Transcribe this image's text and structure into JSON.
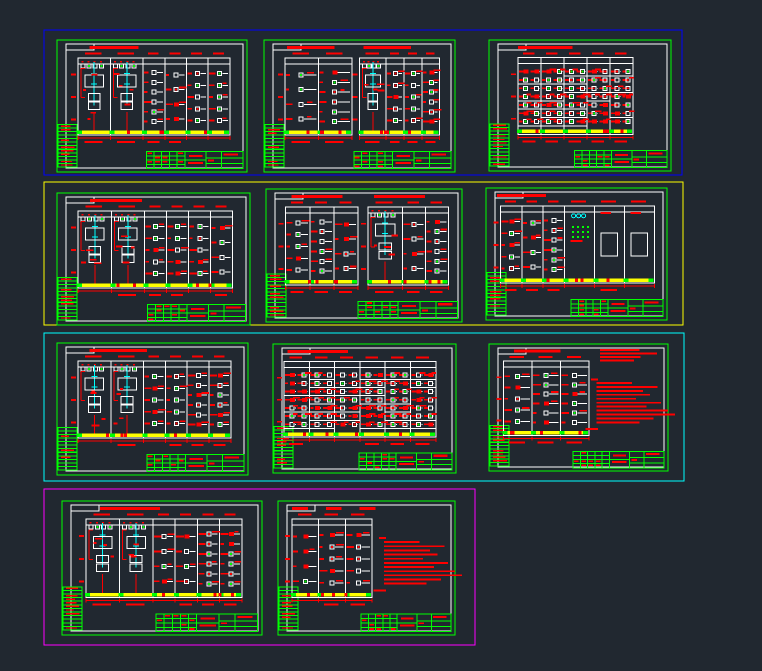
{
  "app": {
    "name": "cad-model-space",
    "background": "#212830",
    "width": 762,
    "height": 671
  },
  "palette": {
    "bg": "#212830",
    "red": "#ff0000",
    "green": "#00e000",
    "bright_green": "#00ff00",
    "white": "#ffffff",
    "yellow": "#ffff00",
    "cyan": "#00ffff",
    "blue": "#0000ff",
    "magenta": "#ff00ff"
  },
  "groups": [
    {
      "name": "group-blue",
      "border_color": "#0000ff",
      "rect": [
        44,
        30,
        638,
        145
      ],
      "sheets": [
        {
          "name": "sheet-r1s1",
          "seed": 11,
          "rect": [
            57,
            40,
            190,
            132
          ],
          "titles": [
            {
              "x": 0.17,
              "w": 0.26
            }
          ],
          "panels": [
            {
              "x0": 0.11,
              "x1": 0.91,
              "cols": 6,
              "feeders": 2
            }
          ]
        },
        {
          "name": "sheet-r1s2",
          "seed": 23,
          "rect": [
            264,
            40,
            191,
            132
          ],
          "titles": [
            {
              "x": 0.12,
              "w": 0.25
            },
            {
              "x": 0.52,
              "w": 0.25
            }
          ],
          "panels": [
            {
              "x0": 0.11,
              "x1": 0.46,
              "cols": 2,
              "feeders": 0
            },
            {
              "x0": 0.5,
              "x1": 0.92,
              "cols": 4,
              "feeders": 1
            }
          ]
        },
        {
          "name": "sheet-r1s3",
          "seed": 37,
          "rect": [
            489,
            40,
            182,
            131
          ],
          "titles": [
            {
              "x": 0.16,
              "w": 0.3
            }
          ],
          "panels": [
            {
              "x0": 0.16,
              "x1": 0.79,
              "cols": 5,
              "feeders": 0,
              "dense": true
            }
          ]
        }
      ]
    },
    {
      "name": "group-yellow",
      "border_color": "#ffff00",
      "rect": [
        44,
        182,
        639,
        143
      ],
      "sheets": [
        {
          "name": "sheet-r2s1",
          "seed": 41,
          "rect": [
            57,
            193,
            193,
            132
          ],
          "titles": [
            {
              "x": 0.17,
              "w": 0.27
            }
          ],
          "panels": [
            {
              "x0": 0.11,
              "x1": 0.91,
              "cols": 6,
              "feeders": 2
            }
          ]
        },
        {
          "name": "sheet-r2s2",
          "seed": 53,
          "rect": [
            266,
            189,
            196,
            133
          ],
          "titles": [
            {
              "x": 0.13,
              "w": 0.26
            },
            {
              "x": 0.55,
              "w": 0.26
            }
          ],
          "panels": [
            {
              "x0": 0.1,
              "x1": 0.47,
              "cols": 3,
              "feeders": 0
            },
            {
              "x0": 0.52,
              "x1": 0.93,
              "cols": 3,
              "feeders": 1
            }
          ]
        },
        {
          "name": "sheet-r2s3",
          "seed": 67,
          "rect": [
            486,
            188,
            181,
            132
          ],
          "titles": [
            {
              "x": 0.06,
              "w": 0.27
            }
          ],
          "panels": [
            {
              "x0": 0.08,
              "x1": 0.93,
              "cols": 6,
              "feeders": 0,
              "sparse_right": 3
            }
          ]
        }
      ]
    },
    {
      "name": "group-cyan",
      "border_color": "#00ffff",
      "rect": [
        44,
        333,
        640,
        148
      ],
      "sheets": [
        {
          "name": "sheet-r3s1",
          "seed": 71,
          "rect": [
            57,
            343,
            191,
            132
          ],
          "titles": [
            {
              "x": 0.17,
              "w": 0.3
            }
          ],
          "panels": [
            {
              "x0": 0.11,
              "x1": 0.91,
              "cols": 6,
              "feeders": 2
            }
          ]
        },
        {
          "name": "sheet-r3s2",
          "seed": 83,
          "rect": [
            273,
            344,
            183,
            129
          ],
          "titles": [
            {
              "x": 0.08,
              "w": 0.33
            }
          ],
          "panels": [
            {
              "x0": 0.06,
              "x1": 0.89,
              "cols": 6,
              "feeders": 0,
              "dense": true
            }
          ]
        },
        {
          "name": "sheet-r3s3",
          "seed": 97,
          "rect": [
            489,
            344,
            179,
            127
          ],
          "titles": [
            {
              "x": 0.14,
              "w": 0.26
            }
          ],
          "panels": [
            {
              "x0": 0.08,
              "x1": 0.56,
              "cols": 3,
              "feeders": 0
            }
          ],
          "notes": true,
          "notes_top": true
        }
      ]
    },
    {
      "name": "group-magenta",
      "border_color": "#ff00ff",
      "rect": [
        44,
        489,
        431,
        156
      ],
      "sheets": [
        {
          "name": "sheet-r4s1",
          "seed": 103,
          "rect": [
            62,
            501,
            200,
            134
          ],
          "titles": [
            {
              "x": 0.19,
              "w": 0.3
            }
          ],
          "panels": [
            {
              "x0": 0.12,
              "x1": 0.9,
              "cols": 6,
              "feeders": 2
            }
          ]
        },
        {
          "name": "sheet-r4s2",
          "seed": 113,
          "rect": [
            278,
            501,
            177,
            134
          ],
          "titles": [
            {
              "x": 0.08,
              "w": 0.09
            },
            {
              "x": 0.27,
              "w": 0.09
            },
            {
              "x": 0.46,
              "w": 0.09
            }
          ],
          "panels": [
            {
              "x0": 0.08,
              "x1": 0.53,
              "cols": 3,
              "feeders": 0
            }
          ],
          "notes": true
        }
      ]
    }
  ],
  "sheet_layout": {
    "frame_inset": {
      "left": 9,
      "top": 4,
      "right": 4,
      "bottom": 4
    },
    "grid_top": 0.135,
    "grid_bottom": 0.72,
    "bus_top": 0.685,
    "title_y": 0.045,
    "header_y": 0.095,
    "strip_top": 0.64,
    "strip_rows": 12,
    "title_block": {
      "x0": 0.47,
      "x1": 0.978,
      "y0": 0.845,
      "y1": 0.975
    }
  }
}
